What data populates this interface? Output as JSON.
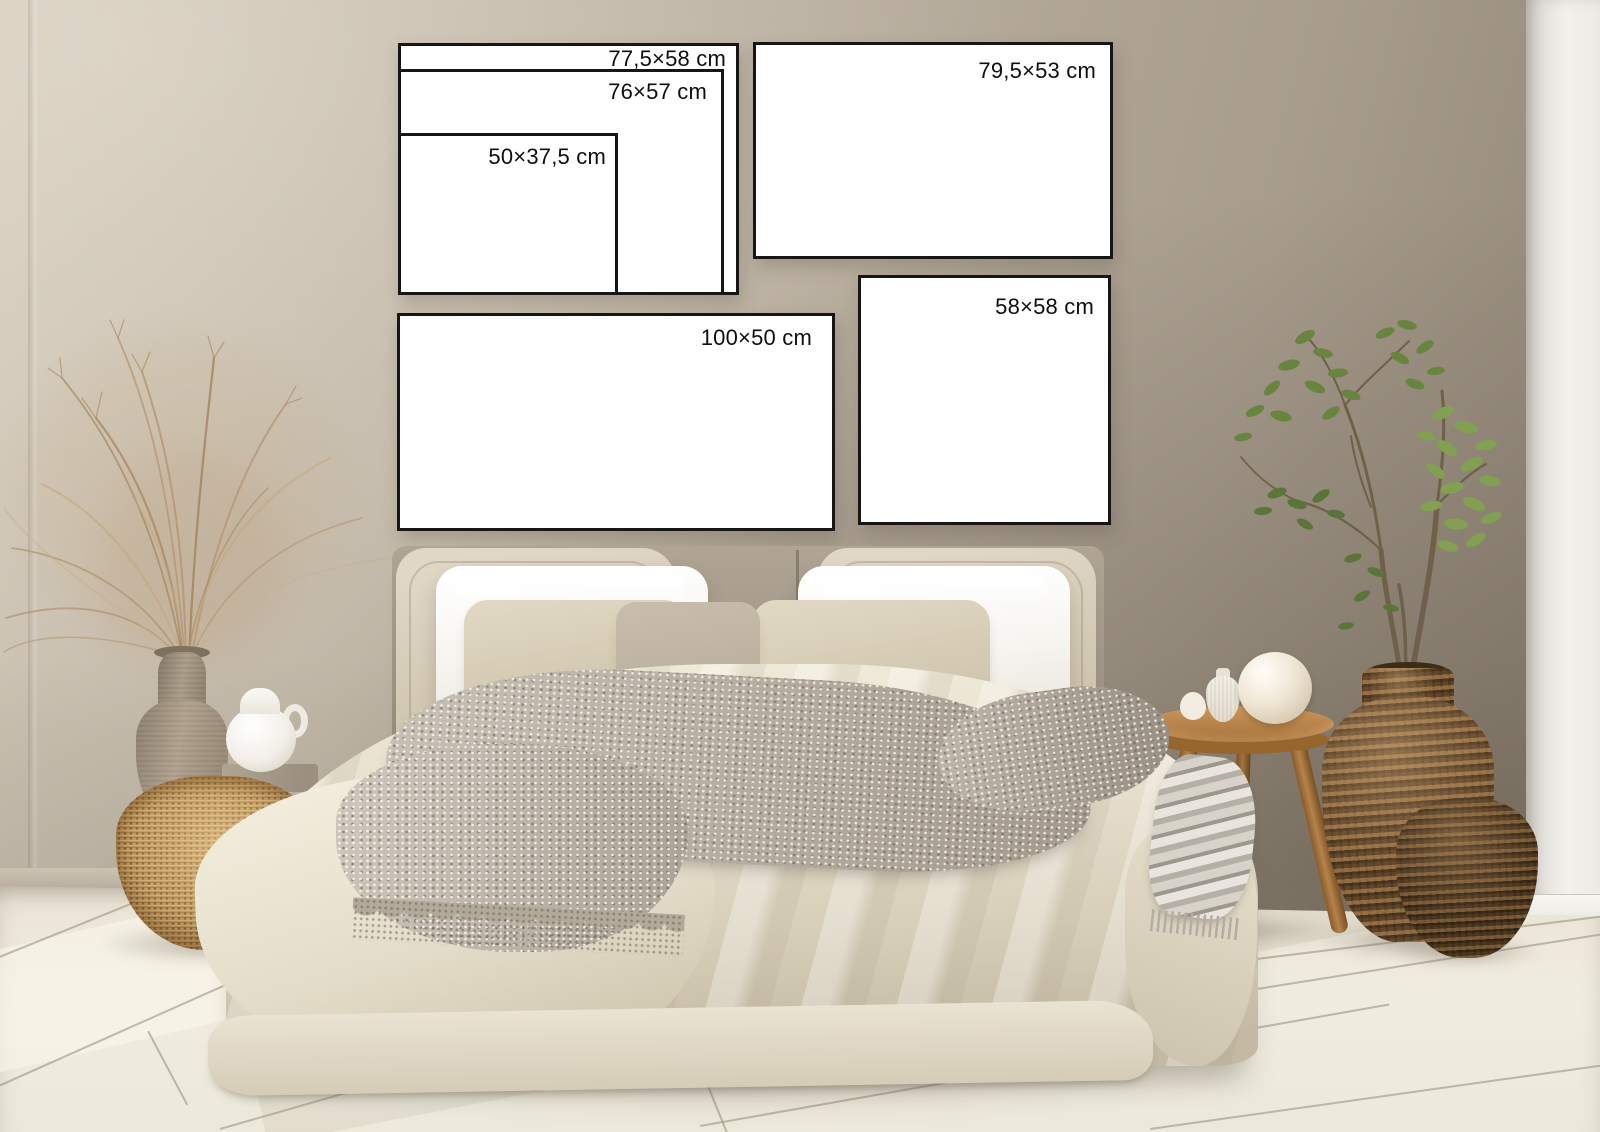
{
  "scene": {
    "type": "bedroom wall-art size mockup photograph",
    "colors": {
      "wall": "#b6ab9b",
      "wall_light": "#d2c8b8",
      "wall_shadow": "#8d8272",
      "white_wall": "#f1f0ec",
      "floor": "#ece7d9",
      "frame_fill": "#ffffff",
      "frame_border": "#161616",
      "label_text": "#0e0e0e",
      "duvet": "#e6dfcc",
      "pillow_white": "#f6f4ef",
      "pillow_flax": "#cdc3ae",
      "throw_knit": "#b5ab9c",
      "rattan": "#c49c62",
      "dark_wicker": "#7a5a36",
      "wood": "#b07c44",
      "ceramic_greige": "#b3a491",
      "ceramic_white": "#f2efe8",
      "leaf_green": "#74914a"
    }
  },
  "frames": [
    {
      "id": "frame-77-5x58",
      "label": "77,5×58 cm"
    },
    {
      "id": "frame-76x57",
      "label": "76×57 cm"
    },
    {
      "id": "frame-50x37-5",
      "label": "50×37,5 cm"
    },
    {
      "id": "frame-79-5x53",
      "label": "79,5×53 cm"
    },
    {
      "id": "frame-58x58",
      "label": "58×58 cm"
    },
    {
      "id": "frame-100x50",
      "label": "100×50 cm"
    }
  ]
}
